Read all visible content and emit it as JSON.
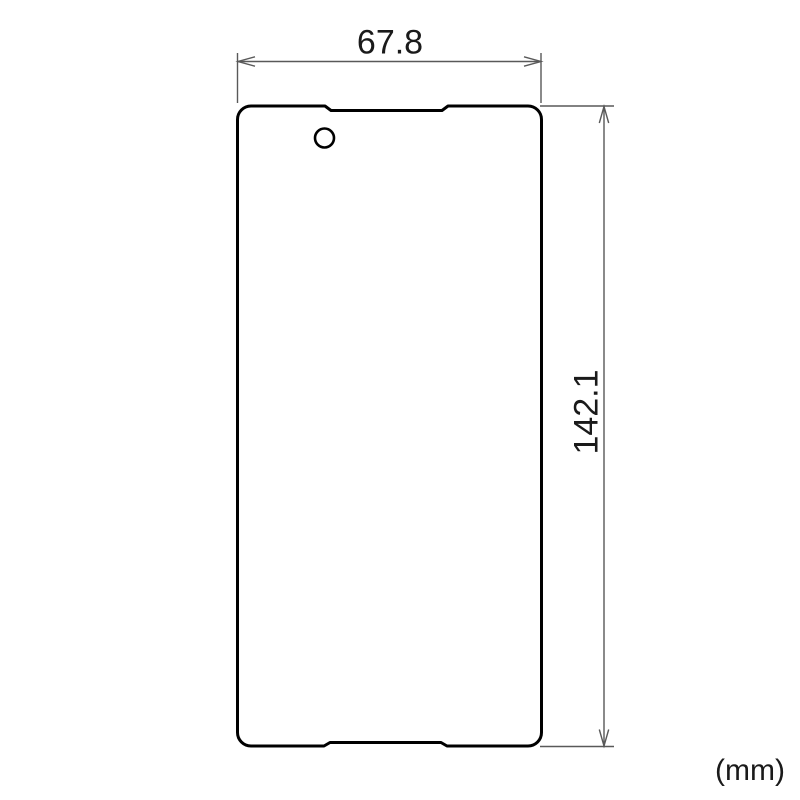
{
  "diagram": {
    "unit_label": "(mm)",
    "dimensions": {
      "width": {
        "value": "67.8"
      },
      "height": {
        "value": "142.1"
      }
    },
    "colors": {
      "background": "#ffffff",
      "outline": "#000000",
      "film_fill": "#ffffff",
      "dimension_line": "#595959",
      "text": "#1a1a1a"
    }
  }
}
